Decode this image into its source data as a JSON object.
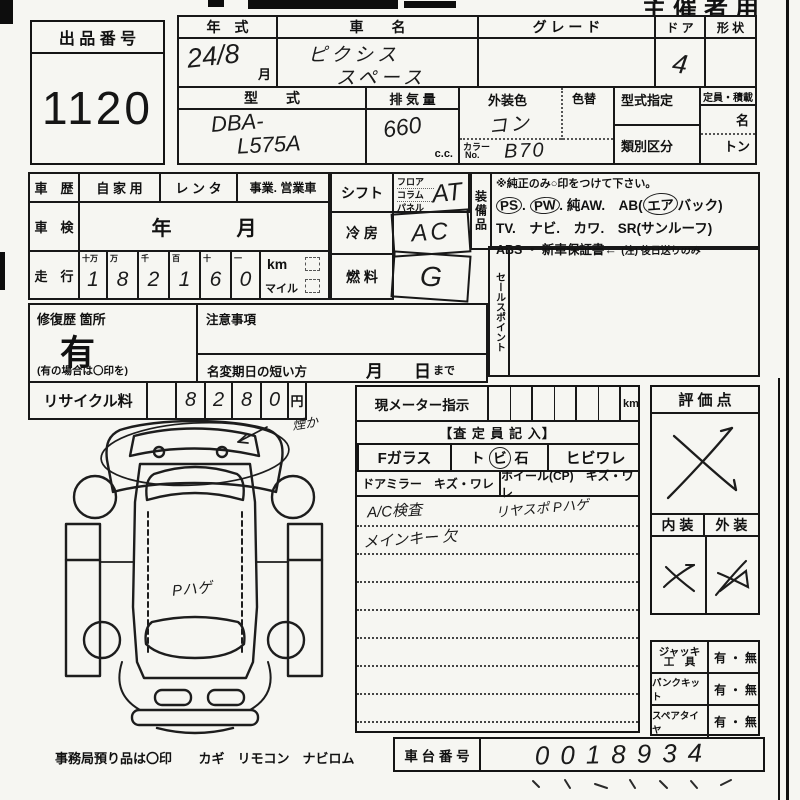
{
  "colors": {
    "paper": "#f6f6f2",
    "ink": "#151515"
  },
  "page": {
    "organizer_label": "主催者用",
    "office_note": "事務局預り品は〇印",
    "office_items": "カギ　リモコン　ナビロム"
  },
  "lot": {
    "label": "出 品 番 号",
    "number": "1120"
  },
  "top_table": {
    "year": {
      "label": "年　式",
      "value": "24/8",
      "suffix": "月"
    },
    "name": {
      "label": "車　　名",
      "line1": "ピクシス",
      "line2": "スペース"
    },
    "grade": {
      "label": "グ レ ー ド"
    },
    "door": {
      "label": "ド ア",
      "value": "4"
    },
    "shape": {
      "label": "形 状"
    },
    "model": {
      "label": "型　　式",
      "line1": "DBA-",
      "line2": "L575A"
    },
    "displacement": {
      "label": "排 気 量",
      "value": "660",
      "unit": "c.c."
    },
    "exterior_color": {
      "label": "外装色",
      "value": "コン"
    },
    "color_change": {
      "label": "色替"
    },
    "color_no": {
      "label1": "カラー",
      "label2": "No.",
      "value": "B70"
    },
    "type_designation": {
      "label": "型式指定"
    },
    "class_category": {
      "label": "類別区分"
    },
    "capacity": {
      "label": "定員・積載",
      "person": "名",
      "ton": "トン"
    }
  },
  "history": {
    "label": "車　歴",
    "private": "自 家 用",
    "rental": "レ ン タ",
    "business": "事業. 営業車",
    "shaken_label": "車　検",
    "shaken_year": "年",
    "shaken_month": "月",
    "mileage_label": "走　行",
    "digit_headers": [
      "十万",
      "万",
      "千",
      "百",
      "十",
      "一"
    ],
    "digits": [
      "1",
      "8",
      "2",
      "1",
      "6",
      "0"
    ],
    "km": "km",
    "mile": "マイル"
  },
  "controls": {
    "shift_label": "シフト",
    "shift_opts": [
      "フロア",
      "コラム",
      "パネル"
    ],
    "shift_value": "AT",
    "ac_label": "冷 房",
    "ac_value": "AC",
    "fuel_label": "燃 料",
    "fuel_value": "G"
  },
  "equipment": {
    "strip": "装備品",
    "note": "※純正のみ○印をつけて下さい。",
    "row1": {
      "i1": "PS",
      "p1": ".",
      "i2": "PW",
      "p2": ".",
      "rest": "純AW.　AB(",
      "air": "エア",
      "close": "バック)"
    },
    "row2": "TV.　ナビ.　カワ.　SR(サンルーフ)",
    "row3": "ABS ・ 新車保証書←",
    "row3_note": "(注) 後日送りのみ"
  },
  "salespoint": {
    "strip": "セールスポイント"
  },
  "repair": {
    "label": "修復歴 箇所",
    "value": "有",
    "note": "(有の場合は〇印を)",
    "caution_label": "注意事項",
    "rename_label": "名変期日の短い方",
    "month": "月",
    "day": "日",
    "made": "まで"
  },
  "recycle": {
    "label": "リサイクル料",
    "digits": [
      "",
      "8",
      "2",
      "8",
      "0"
    ],
    "unit": "円"
  },
  "assessor": {
    "meter_label": "現メーター指示",
    "meter_unit": "km",
    "header": "【査 定 員 記 入】",
    "fglass": "Fガラス",
    "tobi_l": "ト",
    "tobi_m": "ビ",
    "tobi_r": "石",
    "hibiware": "ヒビワレ",
    "mirror": "ドアミラー　キズ・ワレ",
    "wheel": "ホイール(CP)　キズ・ワレ",
    "note1": "A/C検査",
    "note2": "リヤスポ Pハゲ",
    "note3": "メインキー 欠"
  },
  "evaluation": {
    "label": "評 価 点",
    "interior": "内 装",
    "exterior": "外 装"
  },
  "tools": {
    "jack_line1": "ジャッキ",
    "jack_line2": "工　具",
    "puncture": "パンクキット",
    "spare": "スペアタイヤ",
    "yesno": "有 ・ 無"
  },
  "chassis": {
    "label": "車 台 番 号",
    "value": "0018934"
  },
  "diagram": {
    "front_note": "煙か",
    "roof_note": "Pハゲ"
  }
}
